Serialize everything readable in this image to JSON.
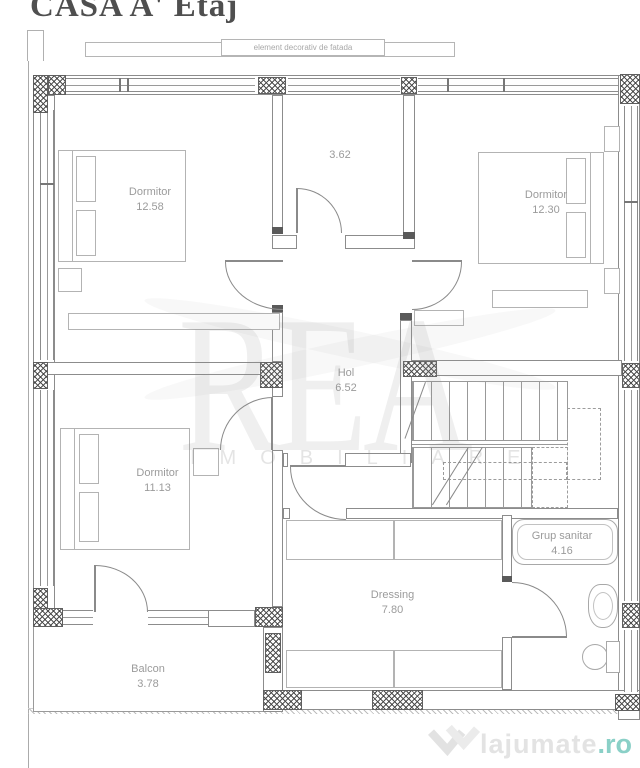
{
  "title": "CASA A' Etaj",
  "facade_note": "element decorativ de fatada",
  "rooms": {
    "dormitor1": {
      "name": "Dormitor",
      "area": "12.58"
    },
    "room_3_62": {
      "area": "3.62"
    },
    "dormitor2": {
      "name": "Dormitor",
      "area": "12.30"
    },
    "hol": {
      "name": "Hol",
      "area": "6.52"
    },
    "dormitor3": {
      "name": "Dormitor",
      "area": "11.13"
    },
    "grup_sanitar": {
      "name": "Grup sanitar",
      "area": "4.16"
    },
    "dressing": {
      "name": "Dressing",
      "area": "7.80"
    },
    "balcon": {
      "name": "Balcon",
      "area": "3.78"
    }
  },
  "watermark": {
    "brand": "REA",
    "subtitle": "IMOBILIARE"
  },
  "logo": {
    "name": "lajumate",
    "tld": ".ro"
  },
  "colors": {
    "logo_accent": "#8ad0c7",
    "plan_lines": "#8c8c8c",
    "room_label_text": "#9b9b9b",
    "title_text": "#4f4f4f"
  }
}
